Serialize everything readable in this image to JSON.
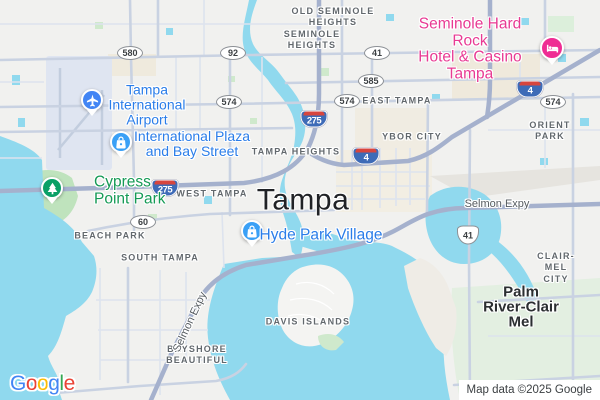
{
  "map": {
    "city": {
      "label": "Tampa"
    },
    "locality": {
      "label": "Palm\nRiver-Clair\nMel"
    },
    "neighborhoods": [
      {
        "label": "OLD SEMINOLE\nHEIGHTS"
      },
      {
        "label": "SEMINOLE\nHEIGHTS"
      },
      {
        "label": "EAST TAMPA"
      },
      {
        "label": "YBOR CITY"
      },
      {
        "label": "ORIENT PARK"
      },
      {
        "label": "TAMPA HEIGHTS"
      },
      {
        "label": "WEST TAMPA"
      },
      {
        "label": "BEACH PARK"
      },
      {
        "label": "SOUTH TAMPA"
      },
      {
        "label": "CLAIR-MEL CITY"
      },
      {
        "label": "DAVIS ISLANDS"
      },
      {
        "label": "BAYSHORE\nBEAUTIFUL"
      }
    ],
    "pois": [
      {
        "name": "Tampa International Airport",
        "label": "Tampa\nInternational\nAirport",
        "icon": "airplane-icon",
        "pin_color": "#4285f4"
      },
      {
        "name": "International Plaza and Bay Street",
        "label": "International Plaza\nand Bay Street",
        "icon": "shopping-bag-icon",
        "pin_color": "#3aa0f6"
      },
      {
        "name": "Hyde Park Village",
        "label": "Hyde Park Village",
        "icon": "shopping-bag-icon",
        "pin_color": "#3aa0f6"
      },
      {
        "name": "Seminole Hard Rock Hotel & Casino Tampa",
        "label": "Seminole Hard Rock\nHotel & Casino Tampa",
        "icon": "bed-icon",
        "pin_color": "#ef2d94"
      },
      {
        "name": "Cypress Point Park",
        "label": "Cypress\nPoint Park",
        "icon": "tree-icon",
        "pin_color": "#0aa066"
      }
    ],
    "shields": {
      "interstate": [
        {
          "num": "275"
        },
        {
          "num": "275"
        },
        {
          "num": "4"
        },
        {
          "num": "4"
        }
      ],
      "oval": [
        {
          "num": "580"
        },
        {
          "num": "92"
        },
        {
          "num": "41"
        },
        {
          "num": "585"
        },
        {
          "num": "574"
        },
        {
          "num": "574"
        },
        {
          "num": "574"
        },
        {
          "num": "60"
        }
      ],
      "us": [
        {
          "num": "41"
        }
      ]
    },
    "road_labels": [
      {
        "label": "Selmon Expy"
      },
      {
        "label": "Selmon Expy"
      }
    ],
    "logo": {
      "letters": [
        "G",
        "o",
        "o",
        "g",
        "l",
        "e"
      ]
    },
    "attribution": {
      "text": "Map data ©2025 Google"
    },
    "colors": {
      "water": "#90d9ee",
      "land": "#f1f1ef",
      "park_green": "#c3e5c0",
      "poi_blue": "#2a7de9",
      "poi_pink": "#e83a93",
      "poi_green": "#159a55",
      "highway": "#a5b1cd",
      "interstate_blue": "#3e6bb7",
      "interstate_red": "#d7453e",
      "neighborhood_gray": "#62686d"
    }
  }
}
